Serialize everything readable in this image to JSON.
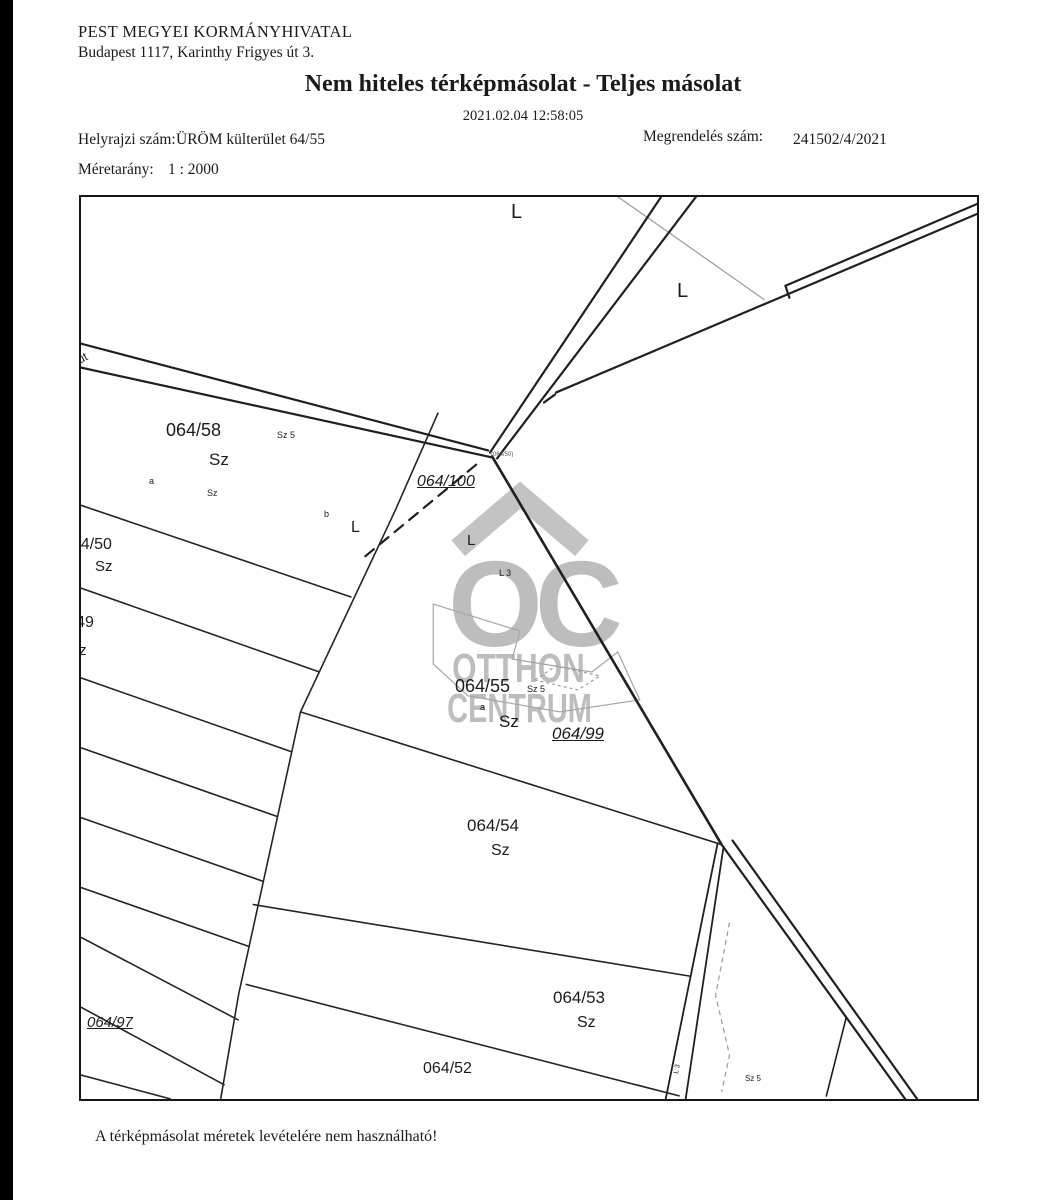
{
  "header": {
    "office_name": "PEST MEGYEI KORMÁNYHIVATAL",
    "office_address": "Budapest 1117, Karinthy Frigyes út 3.",
    "title": "Nem hiteles térképmásolat - Teljes másolat",
    "timestamp": "2021.02.04 12:58:05",
    "parcel_label": "Helyrajzi szám:",
    "parcel_value": "ÜRÖM külterület 64/55",
    "order_label": "Megrendelés szám:",
    "order_value": "241502/4/2021",
    "scale_label": "Méretarány:",
    "scale_value": "1 : 2000"
  },
  "watermark": {
    "monogram": "OC",
    "line1": "OTTHON",
    "line2": "CENTRUM",
    "color": "#bdbdbd"
  },
  "map": {
    "labels": [
      {
        "name": "label-l-top",
        "text": "L",
        "x": 430,
        "y": 5,
        "fs": 20
      },
      {
        "name": "label-l-right",
        "text": "L",
        "x": 596,
        "y": 84,
        "fs": 20
      },
      {
        "name": "label-parcel-064-58",
        "text": "064/58",
        "x": 85,
        "y": 224,
        "fs": 18
      },
      {
        "name": "label-sz5-058",
        "text": "Sz 5",
        "x": 196,
        "y": 234,
        "fs": 9
      },
      {
        "name": "label-sz-058",
        "text": "Sz",
        "x": 128,
        "y": 254,
        "fs": 17
      },
      {
        "name": "label-a-058",
        "text": "a",
        "x": 68,
        "y": 280,
        "fs": 9
      },
      {
        "name": "label-sz-small-058",
        "text": "Sz",
        "x": 126,
        "y": 292,
        "fs": 9
      },
      {
        "name": "label-b",
        "text": "b",
        "x": 243,
        "y": 313,
        "fs": 9
      },
      {
        "name": "label-l-mid",
        "text": "L",
        "x": 270,
        "y": 323,
        "fs": 16
      },
      {
        "name": "label-parcel-064-100",
        "text": "064/100",
        "x": 336,
        "y": 277,
        "fs": 16,
        "cls": "ref"
      },
      {
        "name": "label-junction-ref",
        "text": "(064/50)",
        "x": 410,
        "y": 255,
        "fs": 6,
        "cls": "dim"
      },
      {
        "name": "label-l-center",
        "text": "L",
        "x": 386,
        "y": 336,
        "fs": 15
      },
      {
        "name": "label-l3-center",
        "text": "L 3",
        "x": 418,
        "y": 372,
        "fs": 9
      },
      {
        "name": "label-parcel-064-50",
        "text": "064/50",
        "x": -18,
        "y": 340,
        "fs": 16
      },
      {
        "name": "label-sz-050",
        "text": "Sz",
        "x": 14,
        "y": 362,
        "fs": 15
      },
      {
        "name": "label-parcel-064-49",
        "text": "064/49",
        "x": -36,
        "y": 418,
        "fs": 16
      },
      {
        "name": "label-sz-049",
        "text": "Sz",
        "x": -12,
        "y": 446,
        "fs": 15
      },
      {
        "name": "label-parcel-064-55",
        "text": "064/55",
        "x": 374,
        "y": 480,
        "fs": 18
      },
      {
        "name": "label-sz5-055",
        "text": "Sz 5",
        "x": 446,
        "y": 488,
        "fs": 9
      },
      {
        "name": "label-a-055",
        "text": "a",
        "x": 399,
        "y": 506,
        "fs": 9
      },
      {
        "name": "label-sz-055",
        "text": "Sz",
        "x": 418,
        "y": 516,
        "fs": 17
      },
      {
        "name": "label-parcel-064-99",
        "text": "064/99",
        "x": 471,
        "y": 528,
        "fs": 17,
        "cls": "ref"
      },
      {
        "name": "label-parcel-064-54",
        "text": "064/54",
        "x": 386,
        "y": 620,
        "fs": 17
      },
      {
        "name": "label-sz-054",
        "text": "Sz",
        "x": 410,
        "y": 646,
        "fs": 16
      },
      {
        "name": "label-parcel-064-53",
        "text": "064/53",
        "x": 472,
        "y": 792,
        "fs": 17
      },
      {
        "name": "label-sz-053",
        "text": "Sz",
        "x": 496,
        "y": 818,
        "fs": 16
      },
      {
        "name": "label-parcel-064-52",
        "text": "064/52",
        "x": 342,
        "y": 864,
        "fs": 16
      },
      {
        "name": "label-parcel-064-97",
        "text": "064/97",
        "x": 6,
        "y": 818,
        "fs": 15,
        "cls": "ref"
      },
      {
        "name": "label-sz5-bottom",
        "text": "Sz 5",
        "x": 664,
        "y": 878,
        "fs": 8
      },
      {
        "name": "label-l3-strip",
        "text": "L 3",
        "x": 592,
        "y": 876,
        "fs": 7,
        "cls": "rot-strip"
      },
      {
        "name": "label-road-ut",
        "text": "út",
        "x": -6,
        "y": 158,
        "fs": 12,
        "cls": "rot-road"
      }
    ]
  },
  "footer": {
    "disclaimer": "A térképmásolat méretek levételére nem használható!"
  }
}
